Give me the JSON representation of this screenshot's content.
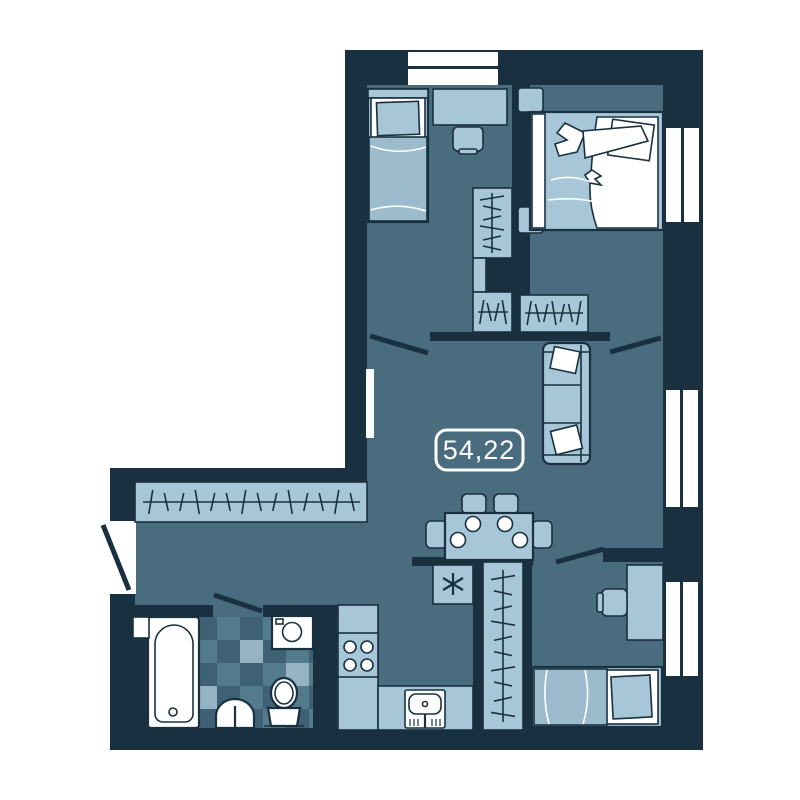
{
  "plan": {
    "title": "apartment-floor-plan",
    "area_label": "54,22"
  },
  "colors": {
    "wall": "#18303f",
    "floor": "#4a6c7f",
    "furn": "#a7c6d7",
    "furn2": "#9cbccd",
    "tileMid": "#547b8c",
    "tileDark": "#3e6173",
    "tileLight": "#95b3c2",
    "labelText": "#ffffff",
    "labelBorder": "#ffffff",
    "background": "#ffffff"
  },
  "icons": {
    "beds": [
      "single-bed-icon-top-left",
      "double-bed-with-person-icon",
      "single-bed-icon-bottom-right"
    ],
    "seating": [
      "sofa-icon",
      "desk-chair-icon-top-left",
      "desk-chair-icon-bottom-right",
      "dining-chair-icons"
    ],
    "tables": [
      "desk-icon-top-left",
      "desk-icon-bottom-right",
      "dining-table-with-plates-icon"
    ],
    "storage": [
      "wardrobe-hangers-icon-a",
      "wardrobe-hangers-icon-b",
      "wardrobe-hangers-icon-c",
      "hallway-wardrobe-icon",
      "closet-wardrobe-icon",
      "nightstand-icons"
    ],
    "kitchen": [
      "fridge-snowflake-icon",
      "stove-4-burners-icon",
      "kitchen-sink-icon",
      "kitchen-counter"
    ],
    "bathroom": [
      "bathtub-icon",
      "washbasin-icon",
      "toilet-icon",
      "washing-machine-icon",
      "tiled-floor"
    ],
    "openings": [
      "top-window",
      "right-window-top",
      "right-window-middle",
      "right-window-bottom",
      "slit-window-west",
      "entrance-door",
      "interior-doors"
    ]
  }
}
